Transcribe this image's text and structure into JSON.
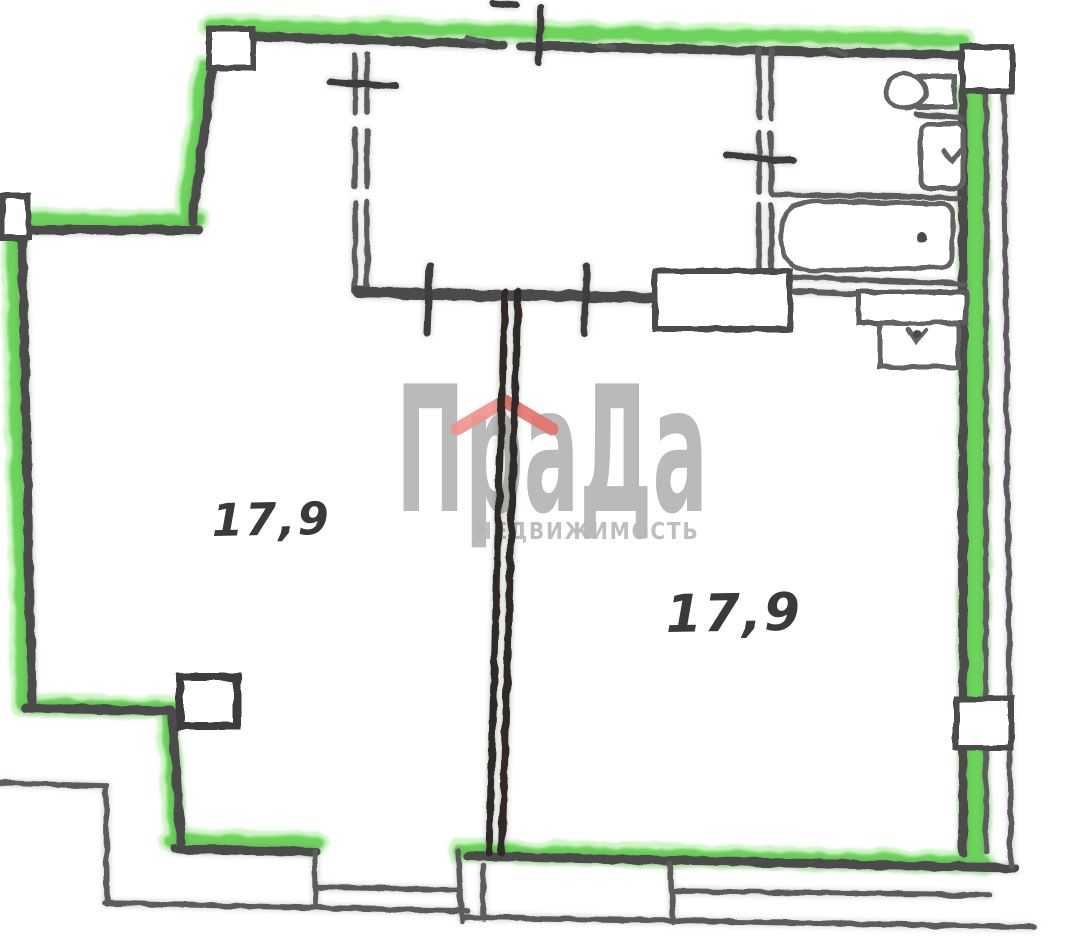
{
  "plan": {
    "rooms": [
      {
        "name": "room-left",
        "area_label": "17,9"
      },
      {
        "name": "room-right",
        "area_label": "17,9"
      }
    ],
    "fixtures": [
      "toilet",
      "washbasin",
      "bathtub",
      "sink",
      "duct-box",
      "entry-door-block"
    ]
  },
  "watermark": {
    "brand": "ПраДа",
    "subtitle": "НЕДВИЖИМОСТЬ"
  },
  "colors": {
    "paper": "#ffffff",
    "wall_highlight": "#5ccf4a",
    "wall_highlight_glow": "#9cea8b",
    "ink": "#4b4b4b",
    "ink_light": "#5c5c5c",
    "partition_ink": "#2d2928",
    "tick_ink": "#3e3e3e",
    "fixture_ink": "#636363",
    "label_ink": "#3a3a3a",
    "watermark_gray": "#b7b7b7",
    "watermark_roof_left": "#f0928c",
    "watermark_roof_right": "#e4736a"
  }
}
